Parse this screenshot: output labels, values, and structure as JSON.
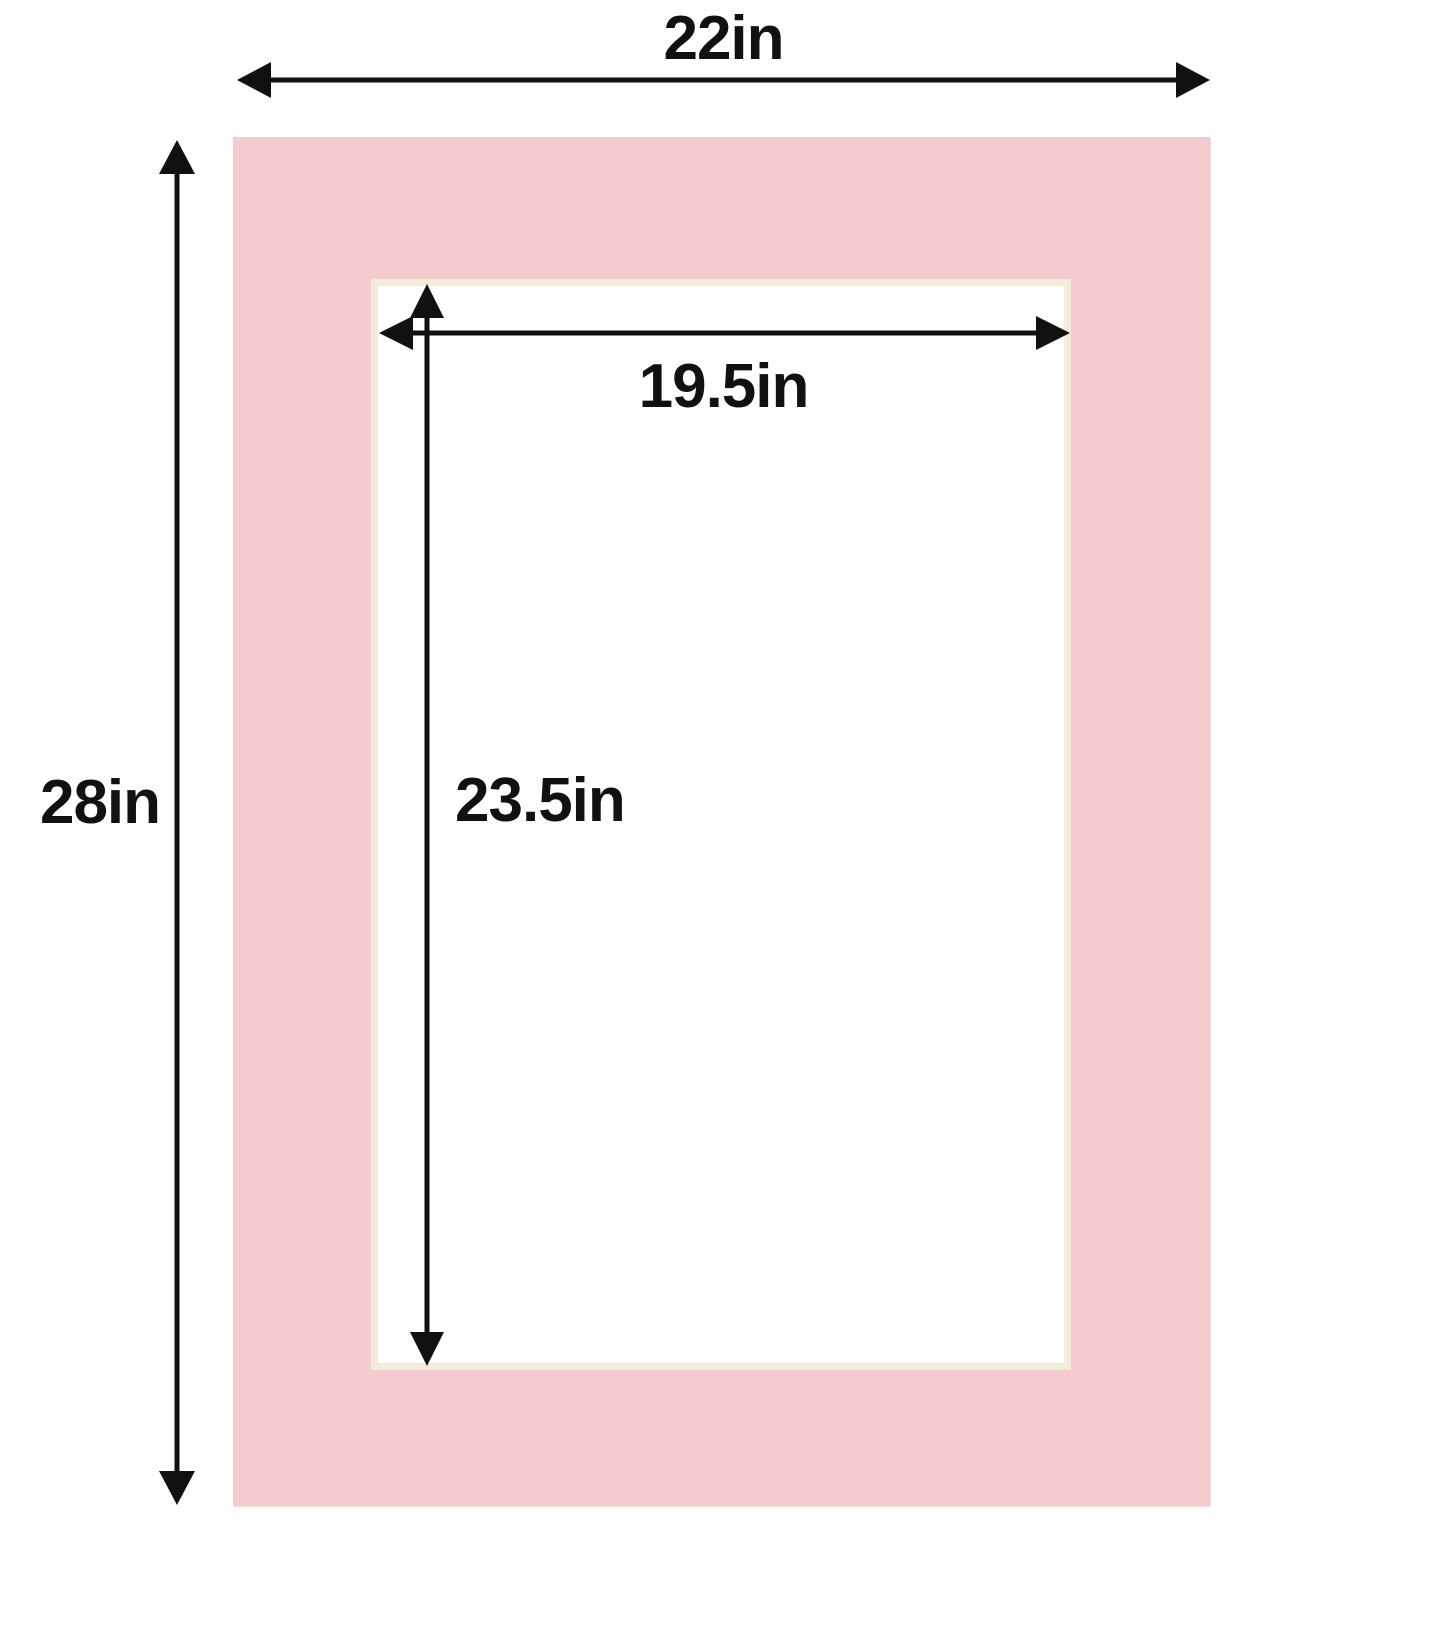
{
  "diagram": {
    "description": "Pink picture frame mat board dimension diagram",
    "labels": {
      "outer_width": "22in",
      "outer_height": "28in",
      "opening_width": "19.5in",
      "opening_height": "23.5in"
    },
    "colors": {
      "mat": "#f6cbd0",
      "bevel": "#f3ecda",
      "arrow": "#111111",
      "background": "#ffffff"
    },
    "icons": {
      "outer_width_arrow": "double-headed-horizontal-arrow",
      "outer_height_arrow": "double-headed-vertical-arrow",
      "opening_width_arrow": "double-headed-horizontal-arrow",
      "opening_height_arrow": "double-headed-vertical-arrow"
    }
  }
}
